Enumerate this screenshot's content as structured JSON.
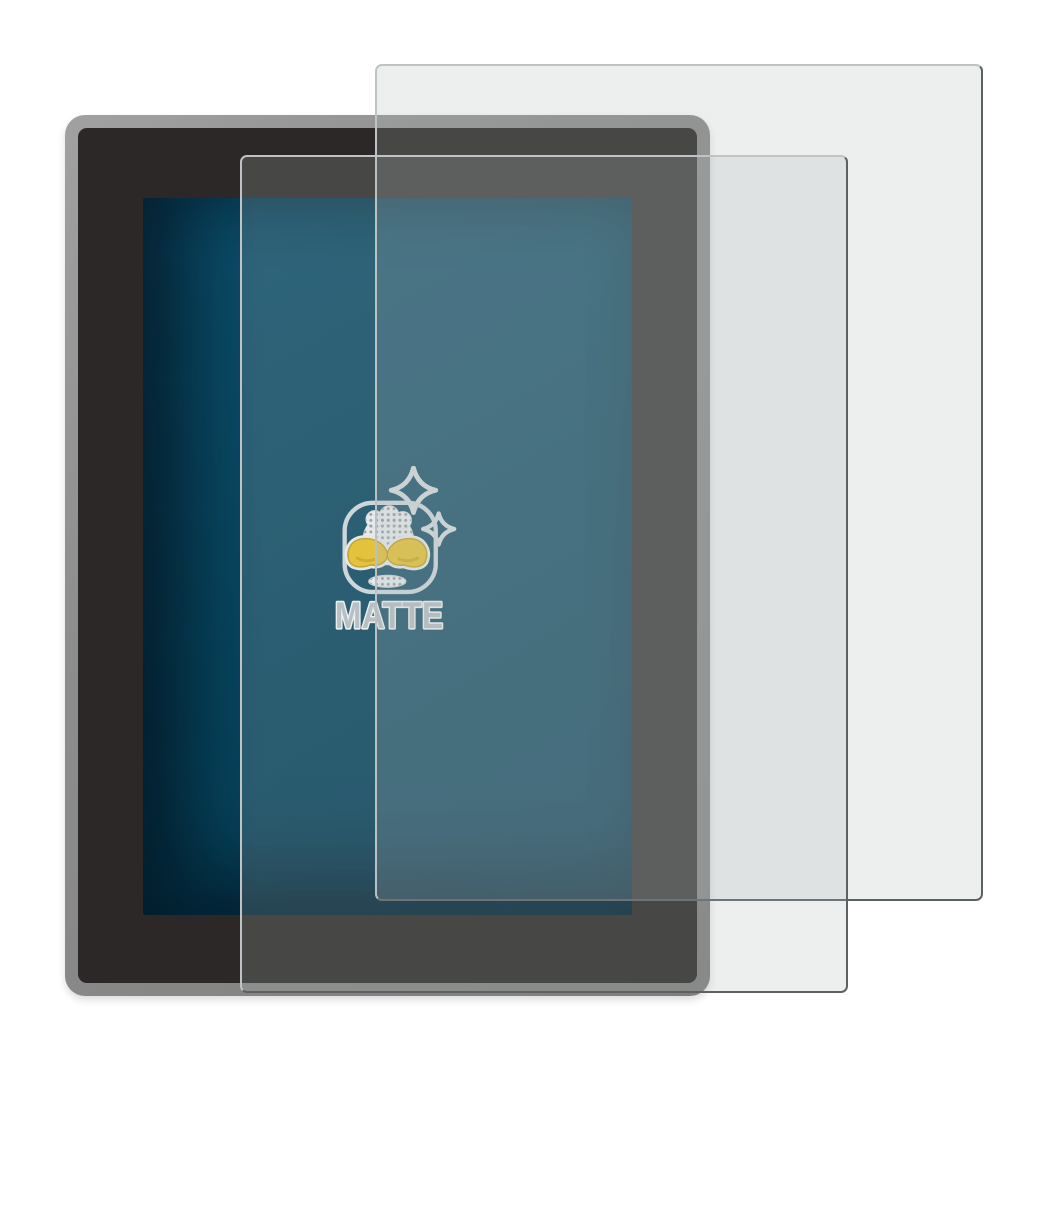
{
  "logo": {
    "label": "MATTE",
    "icon": "sparkles-and-polishing-hands-cloth-icon",
    "colors": {
      "text_fill": "#b9c3ca",
      "text_stroke": "#ffffff",
      "hands_yellow": "#f2c71c",
      "hands_shade": "#d8ab0e",
      "outline_light": "#d6dfe4",
      "halftone_dots": "#949ea4"
    }
  },
  "device": {
    "frame_color": "#8d8d8d",
    "bezel_color": "#2b2827",
    "screen_color": "#07465f"
  },
  "films": {
    "count": 2,
    "tint": "rgba(174,180,184,0.22)",
    "edge_light": "#bfc3c5",
    "edge_dark": "#5d6164"
  },
  "page": {
    "background": "#ffffff"
  }
}
